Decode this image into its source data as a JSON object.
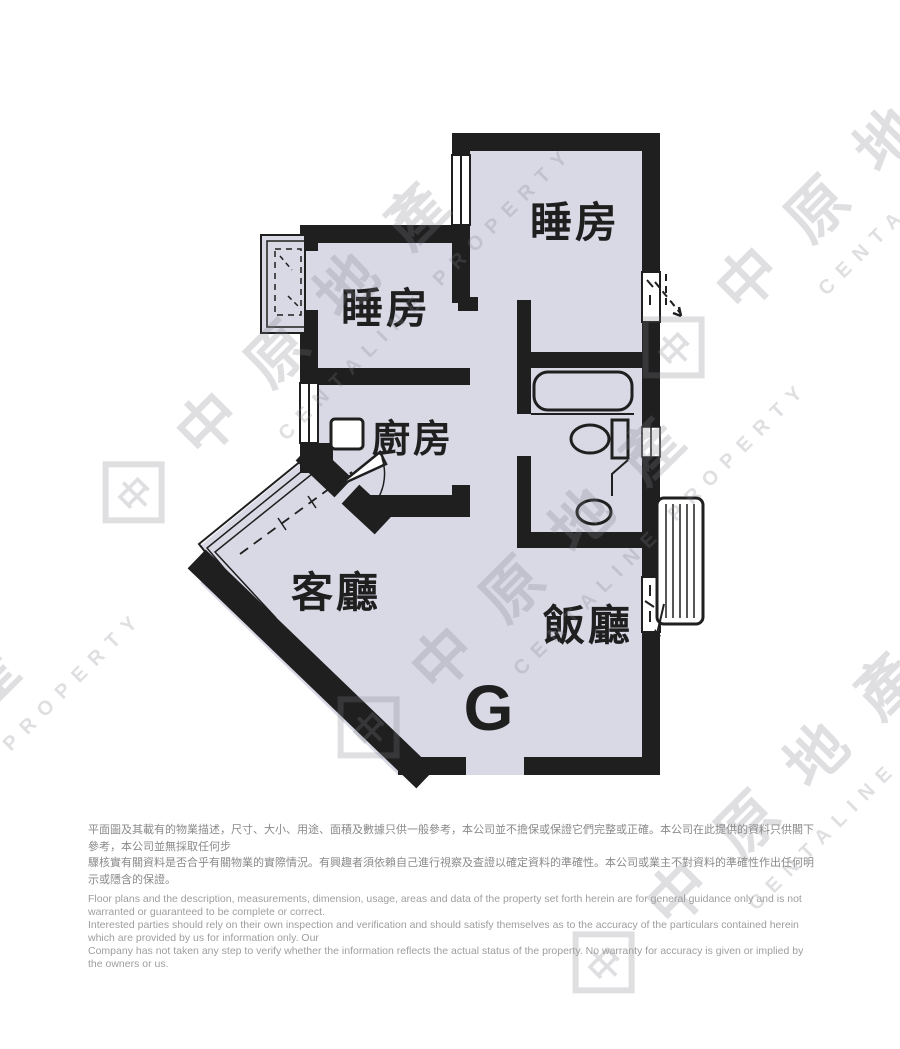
{
  "watermark": {
    "cn": "中原地產",
    "en": "CENTALINE PROPERTY",
    "logo_glyph": "中"
  },
  "floor_plan": {
    "wall_color": "#1f1f1f",
    "floor_color": "#d9d9e6",
    "unit_label": "G",
    "rooms": [
      {
        "id": "bedroom-top-right",
        "label": "睡房"
      },
      {
        "id": "bedroom-left",
        "label": "睡房"
      },
      {
        "id": "kitchen",
        "label": "廚房"
      },
      {
        "id": "living-room",
        "label": "客廳"
      },
      {
        "id": "dining-room",
        "label": "飯廳"
      }
    ],
    "fixture_icons": [
      "bathtub-icon",
      "toilet-icon",
      "washbasin-icon",
      "kitchen-sink-icon",
      "ac-louver-icon",
      "window-icon",
      "door-swing-icon",
      "bay-window-icon"
    ]
  },
  "disclaimer": {
    "zh_line1": "平面圖及其載有的物業描述，尺寸、大小、用途、面積及數據只供一般參考，本公司並不擔保或保證它們完整或正確。本公司在此提供的資料只供閣下參考，本公司並無採取任何步",
    "zh_line2": "驟核實有關資料是否合乎有關物業的實際情況。有興趣者須依賴自己進行視察及查證以確定資料的準確性。本公司或業主不對資料的準確性作出任何明示或隱含的保證。",
    "en_line1": "Floor plans and the description, measurements, dimension, usage, areas and data of the property set forth herein are for general guidance only and is not warranted or guaranteed to be complete or correct.",
    "en_line2": "Interested parties should rely on their own inspection and verification and should satisfy themselves as to the accuracy of the particulars contained herein which are provided by us for information only.  Our",
    "en_line3": "Company has not taken any step to verify whether the information reflects the actual status of the property.  No warranty for accuracy is given or implied by the owners or us."
  }
}
